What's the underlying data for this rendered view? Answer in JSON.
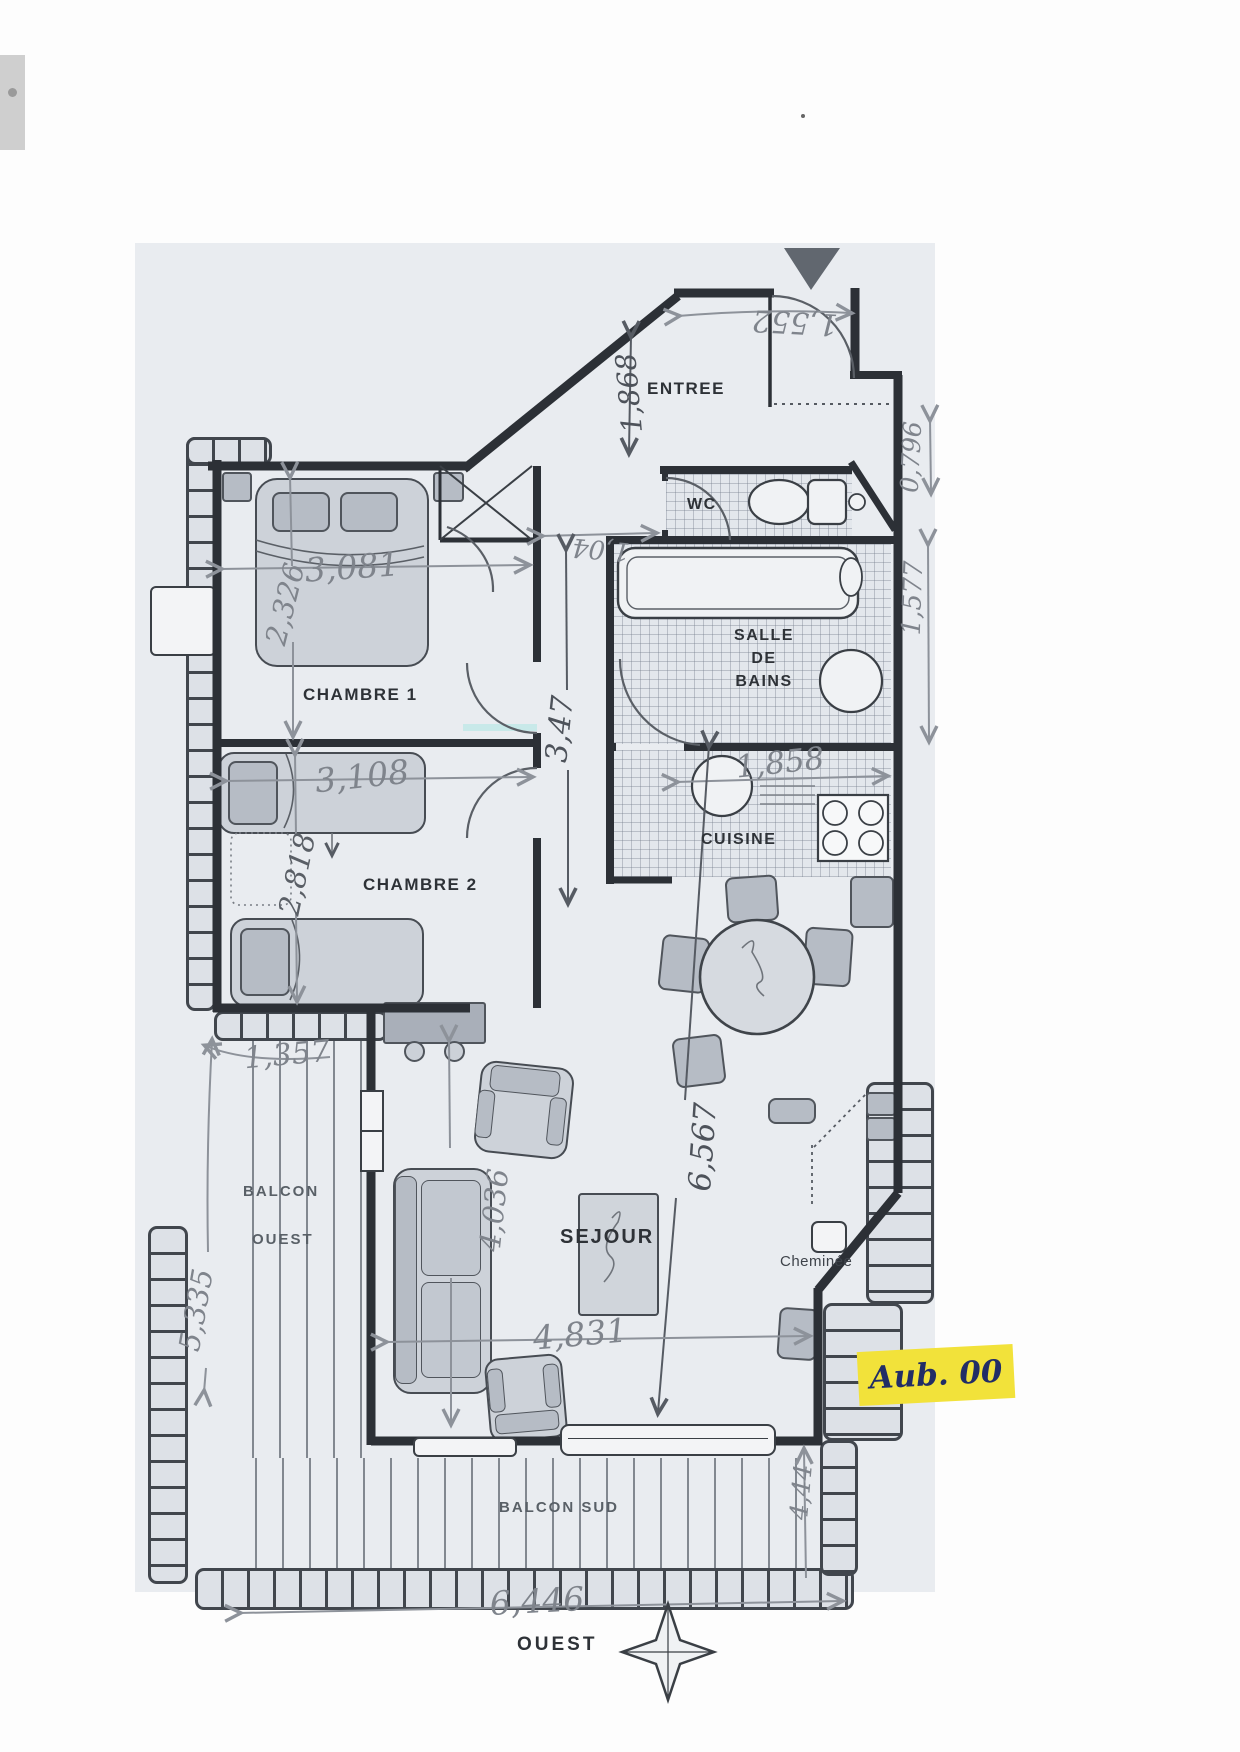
{
  "document": {
    "type_note": "scanned apartment floor plan"
  },
  "rooms": {
    "entree": {
      "label": "ENTREE"
    },
    "wc": {
      "label": "WC"
    },
    "sdb": {
      "label": "SALLE DE BAINS",
      "lines": [
        "SALLE",
        "DE",
        "BAINS"
      ]
    },
    "cuisine": {
      "label": "CUISINE"
    },
    "chambre1": {
      "label": "CHAMBRE 1"
    },
    "chambre2": {
      "label": "CHAMBRE 2"
    },
    "sejour": {
      "label": "SEJOUR"
    },
    "cheminee": {
      "label": "Cheminée"
    },
    "balcon_ouest": {
      "lines": [
        "BALCON",
        "OUEST"
      ]
    },
    "balcon_sud": {
      "label": "BALCON SUD"
    }
  },
  "compass": {
    "label": "OUEST"
  },
  "annotation": {
    "highlight_text": "Aub. 00",
    "highlight_color": "#f2e23a",
    "ink_color": "#222d66"
  },
  "dims": [
    {
      "id": "entry-top-width",
      "value": "1,552"
    },
    {
      "id": "entree-depth",
      "value": "1,868"
    },
    {
      "id": "vestibule-width",
      "value": "1,04"
    },
    {
      "id": "chambre1-width",
      "value": "3,081"
    },
    {
      "id": "chambre1-depth",
      "value": "2,326"
    },
    {
      "id": "chambre2-width",
      "value": "3,108"
    },
    {
      "id": "chambre2-depth",
      "value": "2,818"
    },
    {
      "id": "couloir-length",
      "value": "3,47"
    },
    {
      "id": "cuisine-width",
      "value": "1,858"
    },
    {
      "id": "wc-depth",
      "value": "0,796"
    },
    {
      "id": "sdb-depth",
      "value": "1,577"
    },
    {
      "id": "balcon-ouest-width",
      "value": "1,357"
    },
    {
      "id": "balcon-ouest-length",
      "value": "5,335"
    },
    {
      "id": "sejour-width-left",
      "value": "4,036"
    },
    {
      "id": "sejour-length",
      "value": "6,567"
    },
    {
      "id": "sejour-width",
      "value": "4,831"
    },
    {
      "id": "balcon-sud-depth",
      "value": "4,44"
    },
    {
      "id": "balcon-sud-width",
      "value": "6,446"
    }
  ],
  "colors": {
    "plan_bg": "#e9ecf0",
    "wall": "#2c3036",
    "pencil": "#8d929a",
    "highlight": "#f2e23a"
  }
}
